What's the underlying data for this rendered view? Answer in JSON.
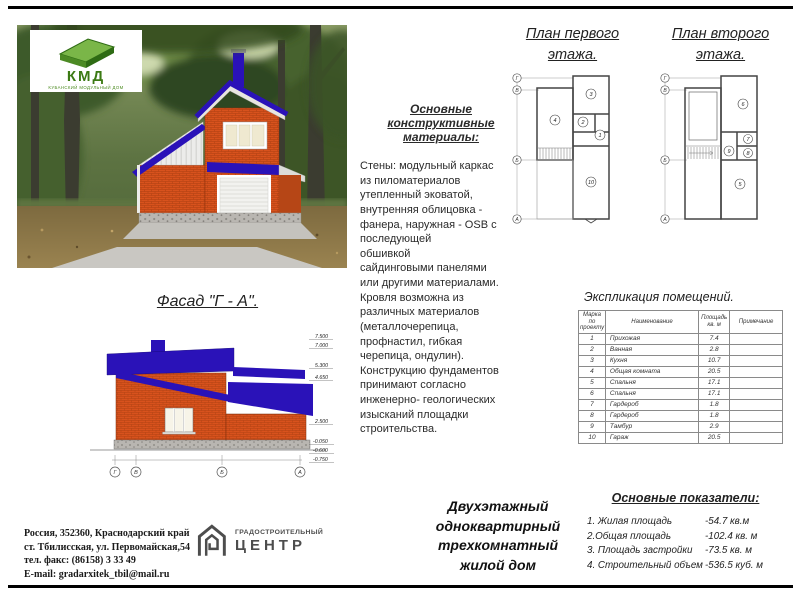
{
  "logo_kmd": {
    "abbr": "КМД",
    "subtitle": "КУБАНСКИЙ МОДУЛЬНЫЙ ДОМ"
  },
  "facade_caption": "Фасад \"Г - А\".",
  "materials": {
    "title": "Основные конструктивные\nматериалы:",
    "body": "Стены: модульный каркас\nиз пиломатериалов\nутепленный эковатой,\nвнутренняя облицовка -\nфанера, наружная - OSB с\nпоследующей\nобшивкой\nсайдинговыми панелями\nили другими материалами.\nКровля возможна из\nразличных материалов\n(металлочерепица,\nпрофнастил, гибкая\nчерепица, ондулин).\nКонструкцию фундаментов\nпринимают согласно\nинженерно- геологических\nизысканий площадки\nстроительства."
  },
  "plans": {
    "first": {
      "title": "План первого\nэтажа.",
      "rooms": [
        "3",
        "4",
        "2",
        "1",
        "10"
      ],
      "axes": [
        "Г",
        "В",
        "Б",
        "А"
      ]
    },
    "second": {
      "title": "План второго\nэтажа.",
      "rooms": [
        "6",
        "7",
        "9",
        "8",
        "5"
      ],
      "axes": [
        "Г",
        "В",
        "Б",
        "А"
      ]
    }
  },
  "explication": {
    "title": "Экспликация помещений.",
    "headers": [
      "Марка\nпо\nпроекту",
      "Наименование",
      "Площадь\nкв. м",
      "Примечание"
    ],
    "rows": [
      [
        "1",
        "Прихожая",
        "7.4",
        ""
      ],
      [
        "2",
        "Ванная",
        "2.8",
        ""
      ],
      [
        "3",
        "Кухня",
        "10.7",
        ""
      ],
      [
        "4",
        "Общая комната",
        "20.5",
        ""
      ],
      [
        "5",
        "Спальня",
        "17.1",
        ""
      ],
      [
        "6",
        "Спальня",
        "17.1",
        ""
      ],
      [
        "7",
        "Гардероб",
        "1.8",
        ""
      ],
      [
        "8",
        "Гардероб",
        "1.8",
        ""
      ],
      [
        "9",
        "Тамбур",
        "2.9",
        ""
      ],
      [
        "10",
        "Гараж",
        "20.5",
        ""
      ]
    ]
  },
  "description": "Двухэтажный\nодноквартирный\nтрехкомнатный\nжилой дом",
  "indicators": {
    "title": "Основные показатели:",
    "items": [
      {
        "label": "1. Жилая площадь",
        "value": "-54.7  кв.м"
      },
      {
        "label": "2.Общая площадь",
        "value": "-102.4 кв. м"
      },
      {
        "label": "3. Площадь застройки",
        "value": "-73.5 кв. м"
      },
      {
        "label": "4. Строительный объем",
        "value": "-536.5 куб. м"
      }
    ]
  },
  "address": {
    "line1": "Россия,  352360, Краснодарский край",
    "line2": "ст. Тбилисская,  ул. Первомайская,54",
    "line3": "тел. факс:  (86158)  3 33 49",
    "line4": "E-mail: gradarxitek_tbil@mail.ru"
  },
  "logo_gradcenter": {
    "line1": "ГРАДОСТРОИТЕЛЬНЫЙ",
    "line2": "ЦЕНТР"
  },
  "elevation": {
    "marks": [
      "7.500",
      "7.000",
      "5.300",
      "4.650",
      "2.500",
      "-0.050",
      "-0.600",
      "-0.750"
    ],
    "axes": [
      "Г",
      "В",
      "Б",
      "А"
    ]
  },
  "colors": {
    "roof_navy": "#2a12b8",
    "brick": "#d8521d",
    "logo_green": "#3c7a14"
  }
}
